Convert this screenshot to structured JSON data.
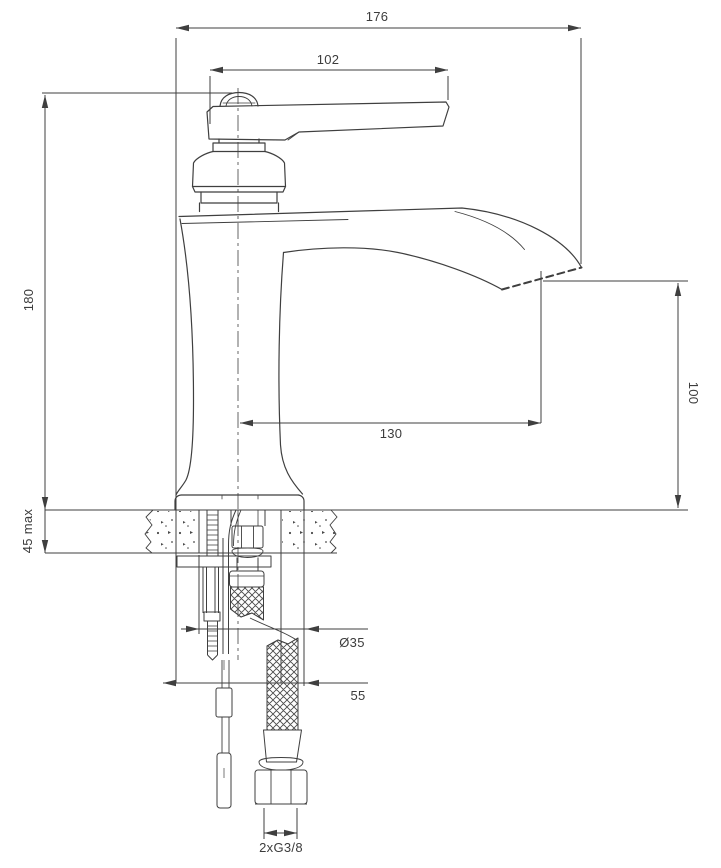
{
  "drawing": {
    "title": "basin-mixer-technical-drawing",
    "background": "#ffffff",
    "line_color": "#3f3f3f",
    "text_color": "#3c3c3c",
    "dimensions": {
      "total_width": "176",
      "handle_length": "102",
      "body_height": "180",
      "spout_height": "100",
      "spout_reach": "130",
      "deck_thickness": "45 max",
      "hole_diameter": "Ø35",
      "base_diameter": "55",
      "hose_thread": "2xG3/8"
    }
  }
}
